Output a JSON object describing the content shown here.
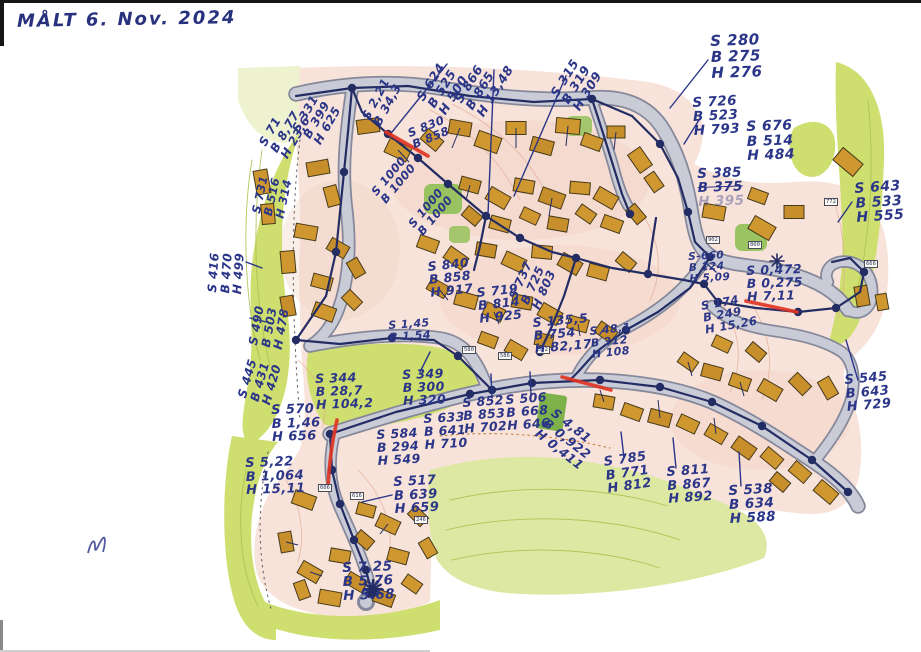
{
  "scan": {
    "header_note": "MÅLT  6. Nov. 2024"
  },
  "ink": {
    "blue": "#2b3688",
    "navy": "#232c63",
    "red": "#e03524"
  },
  "map_colors": {
    "land_pink": "#f8e3da",
    "green_bright": "#cede6f",
    "green_pale": "#dde8a3",
    "road_fill": "#c9ccd6",
    "road_casing": "#84889a",
    "building": "#cf9730"
  },
  "annotations": [
    {
      "x": 414,
      "y": 96,
      "rot": -58,
      "size": 12.5,
      "lines": [
        "S 624",
        "B 525",
        "H 500"
      ]
    },
    {
      "x": 452,
      "y": 98,
      "rot": -58,
      "size": 12.5,
      "lines": [
        "S 866",
        "B 865",
        "H 13,48"
      ]
    },
    {
      "x": 548,
      "y": 92,
      "rot": -58,
      "size": 12.5,
      "lines": [
        "S 315",
        "B 319",
        "H 309"
      ]
    },
    {
      "x": 710,
      "y": 34,
      "rot": -2,
      "size": 15,
      "lines": [
        "S 280",
        "B 275",
        "H 276"
      ]
    },
    {
      "x": 692,
      "y": 96,
      "rot": -3,
      "size": 13.5,
      "lines": [
        "S 726",
        "B 523",
        "H 793"
      ]
    },
    {
      "x": 746,
      "y": 120,
      "rot": -2,
      "size": 14,
      "lines": [
        "S 676",
        "B 514",
        "H 484"
      ]
    },
    {
      "x": 697,
      "y": 167,
      "rot": -2,
      "size": 13.5,
      "lines": [
        "S 385",
        "B 375",
        "H 395"
      ],
      "strike": [
        1
      ],
      "faint": [
        2
      ]
    },
    {
      "x": 854,
      "y": 182,
      "rot": -4,
      "size": 14,
      "lines": [
        "S 643",
        "B 533",
        "H 555"
      ]
    },
    {
      "x": 688,
      "y": 252,
      "rot": -3,
      "size": 10.5,
      "lines": [
        "S-660",
        "B 124",
        "H 5,09"
      ]
    },
    {
      "x": 746,
      "y": 264,
      "rot": -2,
      "size": 12.5,
      "lines": [
        "S 0,472",
        "B 0,275",
        "H 7,11"
      ]
    },
    {
      "x": 844,
      "y": 374,
      "rot": -5,
      "size": 13,
      "lines": [
        "S 545",
        "B 643",
        "H 729"
      ]
    },
    {
      "x": 700,
      "y": 300,
      "rot": -10,
      "size": 11.5,
      "lines": [
        "S 174",
        "B 249",
        "H 15,26"
      ]
    },
    {
      "x": 206,
      "y": 292,
      "rot": -86,
      "size": 12,
      "lines": [
        "S 416",
        "B 470",
        "H 499"
      ]
    },
    {
      "x": 247,
      "y": 344,
      "rot": -80,
      "size": 12,
      "lines": [
        "S 490",
        "B 503",
        "H 478"
      ]
    },
    {
      "x": 236,
      "y": 396,
      "rot": -74,
      "size": 12,
      "lines": [
        "S 445",
        "B 431",
        "H 420"
      ]
    },
    {
      "x": 271,
      "y": 404,
      "rot": -2,
      "size": 13,
      "lines": [
        "S 570",
        "B 1,46",
        "H 656"
      ]
    },
    {
      "x": 245,
      "y": 457,
      "rot": -2,
      "size": 13,
      "lines": [
        "S 5,22",
        "B 1,064",
        "H 15,11"
      ]
    },
    {
      "x": 393,
      "y": 476,
      "rot": -3,
      "size": 13,
      "lines": [
        "S 517",
        "B 639",
        "H 659"
      ]
    },
    {
      "x": 376,
      "y": 428,
      "rot": -3,
      "size": 12.5,
      "lines": [
        "S 584",
        "B 294",
        "H 549"
      ]
    },
    {
      "x": 423,
      "y": 412,
      "rot": -3,
      "size": 12.5,
      "lines": [
        "S 633",
        "B 641",
        "H 710"
      ]
    },
    {
      "x": 315,
      "y": 372,
      "rot": -2,
      "size": 12.5,
      "lines": [
        "S 344",
        "B 28,7",
        "H 104,2"
      ]
    },
    {
      "x": 402,
      "y": 368,
      "rot": -2,
      "size": 12.5,
      "lines": [
        "S 349",
        "B 300",
        "H 320"
      ]
    },
    {
      "x": 462,
      "y": 396,
      "rot": -4,
      "size": 12.5,
      "lines": [
        "S 852",
        "B 853",
        "H 702"
      ]
    },
    {
      "x": 505,
      "y": 393,
      "rot": -4,
      "size": 12.5,
      "lines": [
        "S 506",
        "B 668",
        "H 646"
      ]
    },
    {
      "x": 557,
      "y": 406,
      "rot": 38,
      "size": 12.5,
      "lines": [
        "S 4,81",
        "B 0,922",
        "H 0,411"
      ]
    },
    {
      "x": 603,
      "y": 456,
      "rot": -8,
      "size": 13,
      "lines": [
        "S 785",
        "B 771",
        "H 812"
      ]
    },
    {
      "x": 666,
      "y": 466,
      "rot": -4,
      "size": 13,
      "lines": [
        "S 811",
        "B 867",
        "H 892"
      ]
    },
    {
      "x": 728,
      "y": 484,
      "rot": -3,
      "size": 13.5,
      "lines": [
        "S 538",
        "B 634",
        "H 588"
      ]
    },
    {
      "x": 342,
      "y": 561,
      "rot": -2,
      "size": 13.5,
      "lines": [
        "S 7.25",
        "B 5.76",
        "H 5.68"
      ]
    },
    {
      "x": 427,
      "y": 260,
      "rot": -6,
      "size": 12.5,
      "lines": [
        "S 840",
        "B 858",
        "H 917"
      ]
    },
    {
      "x": 476,
      "y": 286,
      "rot": -6,
      "size": 12.5,
      "lines": [
        "S 719",
        "B 814",
        "H 925"
      ]
    },
    {
      "x": 532,
      "y": 316,
      "rot": -5,
      "size": 12.5,
      "lines": [
        "S 135,5",
        "B 754",
        "H 82,17"
      ]
    },
    {
      "x": 589,
      "y": 326,
      "rot": -6,
      "size": 11,
      "lines": [
        "S 48,1",
        "B 312",
        "H 108"
      ]
    },
    {
      "x": 507,
      "y": 296,
      "rot": -66,
      "size": 12,
      "lines": [
        "S 737",
        "B 725",
        "H 803"
      ]
    },
    {
      "x": 257,
      "y": 142,
      "rot": -60,
      "size": 12,
      "lines": [
        "S 71",
        "B 8,77",
        "H 23,6"
      ]
    },
    {
      "x": 290,
      "y": 128,
      "rot": -60,
      "size": 12,
      "lines": [
        "S 331",
        "B 399",
        "H 625"
      ]
    },
    {
      "x": 360,
      "y": 116,
      "rot": -62,
      "size": 12,
      "lines": [
        "S 2,21",
        "B 34,3"
      ]
    },
    {
      "x": 406,
      "y": 128,
      "rot": -22,
      "size": 11.5,
      "lines": [
        "S 830",
        "B 858"
      ]
    },
    {
      "x": 369,
      "y": 190,
      "rot": -50,
      "size": 11.5,
      "lines": [
        "S 1000",
        "B 1000"
      ]
    },
    {
      "x": 406,
      "y": 222,
      "rot": -50,
      "size": 11.5,
      "lines": [
        "S 1000",
        "B 1000"
      ]
    },
    {
      "x": 250,
      "y": 212,
      "rot": -78,
      "size": 11.5,
      "lines": [
        "S 731",
        "B 516",
        "H 314"
      ]
    },
    {
      "x": 388,
      "y": 320,
      "rot": -4,
      "size": 11,
      "lines": [
        "S 1,45",
        "B 1,54"
      ]
    }
  ],
  "house_labels": [
    {
      "t": "902",
      "x": 706,
      "y": 236
    },
    {
      "t": "800",
      "x": 748,
      "y": 241
    },
    {
      "t": "772",
      "x": 824,
      "y": 198
    },
    {
      "t": "666",
      "x": 864,
      "y": 260
    },
    {
      "t": "606",
      "x": 318,
      "y": 484
    },
    {
      "t": "616",
      "x": 350,
      "y": 492
    },
    {
      "t": "246",
      "x": 414,
      "y": 516
    },
    {
      "t": "580",
      "x": 462,
      "y": 346
    },
    {
      "t": "586",
      "x": 498,
      "y": 352
    },
    {
      "t": "592",
      "x": 536,
      "y": 346
    }
  ]
}
